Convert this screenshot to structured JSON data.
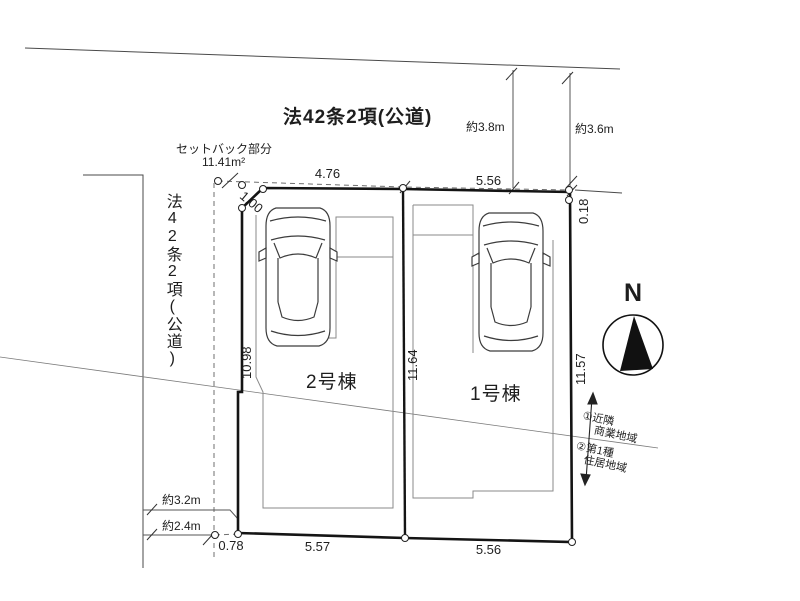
{
  "roads": {
    "top_label": "法42条2項(公道)",
    "left_label": "法42条2項(公道)"
  },
  "setback": {
    "label": "セットバック部分",
    "area": "11.41m²"
  },
  "dimensions": {
    "top_left": "4.76",
    "top_right": "5.56",
    "chamfer": "1.00",
    "corner_offset": "0.18",
    "left_depth": "10.98",
    "center_depth": "11.64",
    "right_depth": "11.57",
    "bottom_offset": "0.78",
    "bottom_left": "5.57",
    "bottom_right": "5.56",
    "road_top_width_left": "約3.8m",
    "road_top_width_right": "約3.6m",
    "road_left_width_upper": "約3.2m",
    "road_left_width_lower": "約2.4m"
  },
  "buildings": {
    "lot2_label": "2号棟",
    "lot1_label": "1号棟"
  },
  "compass": {
    "north_label": "N"
  },
  "zoning": {
    "line1a": "①近隣",
    "line1b": "商業地域",
    "line2a": "②第1種",
    "line2b": "住居地域"
  },
  "colors": {
    "boundary": "#141414",
    "thin_line": "#8a8a8a",
    "road_line": "#4a4a4a",
    "dashed": "#6f6f6f",
    "car_stroke": "#3c3c3c"
  }
}
